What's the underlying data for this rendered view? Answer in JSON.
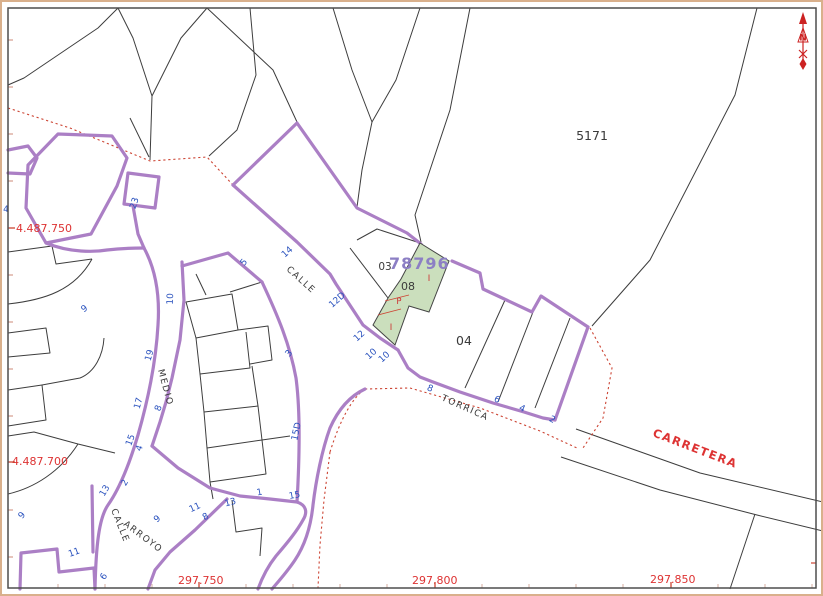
{
  "map": {
    "reference": {
      "value": "78796",
      "x": 389,
      "y": 269
    },
    "north": {
      "label": "N"
    },
    "parcel_labels": [
      {
        "text": "5171",
        "x": 592,
        "y": 140,
        "size": 12.5
      },
      {
        "text": "03",
        "x": 385,
        "y": 270,
        "size": 10.5
      },
      {
        "text": "08",
        "x": 408,
        "y": 290,
        "size": 11
      },
      {
        "text": "04",
        "x": 464,
        "y": 345,
        "size": 12.5
      }
    ],
    "use_labels": [
      {
        "text": "I",
        "x": 429,
        "y": 281
      },
      {
        "text": "P",
        "x": 399,
        "y": 304
      },
      {
        "text": "I",
        "x": 391,
        "y": 330
      }
    ],
    "street_labels": [
      {
        "text": "CALLE",
        "x": 286,
        "y": 270,
        "rot": 42,
        "color": "black"
      },
      {
        "text": "MEDIO",
        "x": 158,
        "y": 370,
        "rot": 75,
        "color": "black"
      },
      {
        "text": "CALLE",
        "x": 111,
        "y": 510,
        "rot": 68,
        "color": "black"
      },
      {
        "text": "ARROYO",
        "x": 123,
        "y": 525,
        "rot": 37,
        "color": "black"
      },
      {
        "text": "TORRICA",
        "x": 441,
        "y": 400,
        "rot": 24,
        "color": "black"
      },
      {
        "text": "CARRETERA",
        "x": 652,
        "y": 436,
        "rot": 21,
        "color": "red"
      }
    ],
    "house_numbers": [
      {
        "text": "4",
        "x": 6,
        "y": 212,
        "rot": 0
      },
      {
        "text": "23",
        "x": 137,
        "y": 204,
        "rot": -72
      },
      {
        "text": "9",
        "x": 86,
        "y": 311,
        "rot": -35
      },
      {
        "text": "10",
        "x": 173,
        "y": 299,
        "rot": -88
      },
      {
        "text": "19",
        "x": 152,
        "y": 356,
        "rot": -75
      },
      {
        "text": "17",
        "x": 141,
        "y": 404,
        "rot": -75
      },
      {
        "text": "15",
        "x": 133,
        "y": 441,
        "rot": -70
      },
      {
        "text": "4",
        "x": 142,
        "y": 449,
        "rot": -70
      },
      {
        "text": "2",
        "x": 127,
        "y": 484,
        "rot": -60
      },
      {
        "text": "13",
        "x": 107,
        "y": 492,
        "rot": -60
      },
      {
        "text": "8",
        "x": 161,
        "y": 409,
        "rot": -70
      },
      {
        "text": "9",
        "x": 24,
        "y": 517,
        "rot": -50
      },
      {
        "text": "11",
        "x": 75,
        "y": 555,
        "rot": -20
      },
      {
        "text": "6",
        "x": 106,
        "y": 578,
        "rot": -55
      },
      {
        "text": "9",
        "x": 159,
        "y": 521,
        "rot": -40
      },
      {
        "text": "11",
        "x": 196,
        "y": 510,
        "rot": -25
      },
      {
        "text": "8",
        "x": 207,
        "y": 519,
        "rot": -30
      },
      {
        "text": "13",
        "x": 231,
        "y": 505,
        "rot": -15
      },
      {
        "text": "1",
        "x": 260,
        "y": 495,
        "rot": -10
      },
      {
        "text": "15",
        "x": 295,
        "y": 498,
        "rot": -10
      },
      {
        "text": "15D",
        "x": 299,
        "y": 432,
        "rot": -78
      },
      {
        "text": "3",
        "x": 291,
        "y": 355,
        "rot": -50
      },
      {
        "text": "5",
        "x": 246,
        "y": 264,
        "rot": -50
      },
      {
        "text": "14",
        "x": 289,
        "y": 254,
        "rot": -42
      },
      {
        "text": "12D",
        "x": 339,
        "y": 302,
        "rot": -42
      },
      {
        "text": "12",
        "x": 361,
        "y": 338,
        "rot": -42
      },
      {
        "text": "10",
        "x": 373,
        "y": 356,
        "rot": -42
      },
      {
        "text": "10",
        "x": 386,
        "y": 359,
        "rot": -42
      },
      {
        "text": "8",
        "x": 429,
        "y": 391,
        "rot": 22
      },
      {
        "text": "6",
        "x": 496,
        "y": 402,
        "rot": 25
      },
      {
        "text": "4",
        "x": 521,
        "y": 411,
        "rot": 25
      },
      {
        "text": "2",
        "x": 551,
        "y": 422,
        "rot": 28
      }
    ],
    "coordinates": {
      "x_labels": [
        {
          "text": "297.750",
          "x": 178,
          "y": 584,
          "tick_x": 199
        },
        {
          "text": "297.800",
          "x": 412,
          "y": 584,
          "tick_x": 435
        },
        {
          "text": "297.850",
          "x": 650,
          "y": 583,
          "tick_x": 671
        }
      ],
      "y_labels": [
        {
          "text": "4.487.750",
          "x": 16,
          "y": 232,
          "tick_y": 228
        },
        {
          "text": "4.487.700",
          "x": 12,
          "y": 465,
          "tick_y": 462
        }
      ]
    }
  },
  "colors": {
    "block_boundary": "#ab7fc5",
    "parcel_line": "#3d3d3d",
    "house_number_blue": "#2a52be",
    "boundary_dotted_red": "#cc4433",
    "selected_parcel_fill": "#cbdfbd",
    "coordinate_red": "#dd3333",
    "reference_purple": "#8c7fc4"
  }
}
